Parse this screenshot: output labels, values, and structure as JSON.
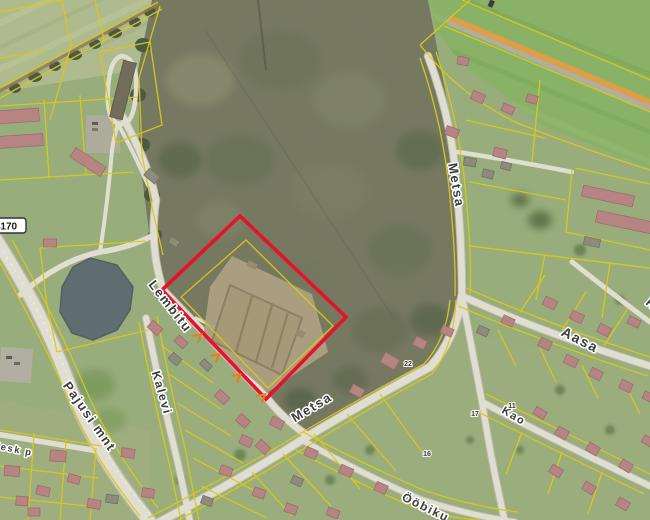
{
  "map": {
    "type": "aerial-cadastral-map",
    "highlight_parcel": {
      "color": "#e8112d",
      "stroke_width": 3.6,
      "points": [
        [
          240,
          216
        ],
        [
          346,
          317
        ],
        [
          266,
          399
        ],
        [
          162,
          290
        ]
      ]
    },
    "street_labels": [
      {
        "id": "lembitu",
        "text": "Lembitu",
        "x": 167,
        "y": 309,
        "rot": 52,
        "size": 13
      },
      {
        "id": "kalevi",
        "text": "Kalevi",
        "x": 158,
        "y": 394,
        "rot": 74,
        "size": 12
      },
      {
        "id": "pajusi-mnt",
        "text": "Pajusi mnt",
        "x": 86,
        "y": 419,
        "rot": 55,
        "size": 13
      },
      {
        "id": "metsa-north",
        "text": "Metsa",
        "x": 452,
        "y": 186,
        "rot": 80,
        "size": 13
      },
      {
        "id": "metsa-central",
        "text": "Metsa",
        "x": 314,
        "y": 411,
        "rot": -31,
        "size": 13
      },
      {
        "id": "aasa",
        "text": "Aasa",
        "x": 578,
        "y": 344,
        "rot": 27,
        "size": 14
      },
      {
        "id": "kao",
        "text": "Kao",
        "x": 512,
        "y": 419,
        "rot": 31,
        "size": 11
      },
      {
        "id": "oobiku",
        "text": "Ööbiku",
        "x": 424,
        "y": 511,
        "rot": 26,
        "size": 12
      },
      {
        "id": "kesk-p",
        "text": "Kesk p",
        "x": 12,
        "y": 452,
        "rot": 11,
        "size": 9.5
      },
      {
        "id": "edge-partial",
        "text": "R",
        "x": 649,
        "y": 307,
        "rot": 40,
        "size": 12
      }
    ],
    "road_number_badge": {
      "text": "4170",
      "x": 2,
      "y": 226
    },
    "house_numbers": [
      {
        "text": "22",
        "x": 408,
        "y": 366
      },
      {
        "text": "17",
        "x": 475,
        "y": 416
      },
      {
        "text": "11",
        "x": 512,
        "y": 408
      },
      {
        "text": "16",
        "x": 427,
        "y": 456
      }
    ],
    "route_markers": {
      "color": "#e0821e",
      "rotation": 52,
      "positions": [
        [
          198,
          337
        ],
        [
          216,
          357
        ],
        [
          237,
          377
        ],
        [
          262,
          397
        ]
      ]
    },
    "houses": [
      [
        18,
        116,
        -4,
        42,
        13,
        "p"
      ],
      [
        20,
        141,
        -4,
        46,
        12,
        "p"
      ],
      [
        88,
        162,
        33,
        36,
        11,
        "p"
      ],
      [
        123,
        90,
        14,
        13,
        58,
        "d"
      ],
      [
        152,
        176,
        40,
        14,
        9,
        "g"
      ],
      [
        174,
        242,
        32,
        10,
        7,
        "g"
      ],
      [
        50,
        243,
        0,
        13,
        8,
        "p"
      ],
      [
        608,
        196,
        12,
        52,
        11,
        "p"
      ],
      [
        624,
        222,
        12,
        56,
        12,
        "p"
      ],
      [
        592,
        242,
        12,
        16,
        8,
        "g"
      ],
      [
        452,
        132,
        20,
        13,
        9,
        "p"
      ],
      [
        500,
        153,
        15,
        13,
        9,
        "p"
      ],
      [
        470,
        162,
        10,
        12,
        8,
        "g"
      ],
      [
        488,
        174,
        15,
        11,
        8,
        "g"
      ],
      [
        506,
        166,
        15,
        10,
        7,
        "g"
      ],
      [
        478,
        97,
        24,
        13,
        9,
        "p"
      ],
      [
        508,
        109,
        24,
        12,
        8,
        "p"
      ],
      [
        532,
        99,
        15,
        11,
        8,
        "p"
      ],
      [
        463,
        61,
        10,
        11,
        8,
        "p"
      ],
      [
        550,
        303,
        26,
        13,
        9,
        "p"
      ],
      [
        577,
        317,
        26,
        13,
        9,
        "p"
      ],
      [
        604,
        330,
        26,
        12,
        9,
        "p"
      ],
      [
        634,
        322,
        26,
        12,
        8,
        "p"
      ],
      [
        545,
        344,
        26,
        12,
        9,
        "p"
      ],
      [
        571,
        361,
        26,
        13,
        9,
        "p"
      ],
      [
        596,
        374,
        26,
        12,
        9,
        "p"
      ],
      [
        626,
        386,
        26,
        12,
        9,
        "p"
      ],
      [
        649,
        397,
        26,
        12,
        8,
        "p"
      ],
      [
        390,
        361,
        30,
        16,
        11,
        "p"
      ],
      [
        357,
        391,
        28,
        13,
        9,
        "p"
      ],
      [
        420,
        343,
        26,
        12,
        9,
        "p"
      ],
      [
        447,
        331,
        24,
        12,
        8,
        "p"
      ],
      [
        483,
        331,
        24,
        11,
        8,
        "g"
      ],
      [
        508,
        321,
        24,
        12,
        8,
        "p"
      ],
      [
        277,
        423,
        26,
        13,
        9,
        "p"
      ],
      [
        246,
        441,
        24,
        12,
        9,
        "p"
      ],
      [
        311,
        453,
        24,
        12,
        9,
        "p"
      ],
      [
        346,
        471,
        24,
        13,
        9,
        "p"
      ],
      [
        381,
        488,
        24,
        12,
        9,
        "p"
      ],
      [
        297,
        481,
        24,
        11,
        8,
        "g"
      ],
      [
        540,
        413,
        31,
        12,
        8,
        "p"
      ],
      [
        562,
        433,
        31,
        12,
        9,
        "p"
      ],
      [
        593,
        449,
        31,
        12,
        9,
        "p"
      ],
      [
        626,
        466,
        31,
        12,
        9,
        "p"
      ],
      [
        556,
        471,
        31,
        12,
        9,
        "p"
      ],
      [
        589,
        488,
        31,
        12,
        9,
        "p"
      ],
      [
        623,
        504,
        31,
        12,
        9,
        "p"
      ],
      [
        648,
        441,
        31,
        11,
        8,
        "p"
      ],
      [
        226,
        471,
        20,
        12,
        9,
        "p"
      ],
      [
        259,
        493,
        20,
        12,
        9,
        "p"
      ],
      [
        291,
        509,
        20,
        12,
        9,
        "p"
      ],
      [
        333,
        513,
        20,
        12,
        8,
        "p"
      ],
      [
        207,
        501,
        20,
        11,
        8,
        "g"
      ],
      [
        155,
        328,
        42,
        13,
        9,
        "p"
      ],
      [
        181,
        342,
        42,
        12,
        8,
        "p"
      ],
      [
        175,
        359,
        42,
        11,
        8,
        "g"
      ],
      [
        206,
        365,
        42,
        11,
        7,
        "g"
      ],
      [
        222,
        397,
        42,
        13,
        9,
        "p"
      ],
      [
        243,
        421,
        42,
        12,
        9,
        "p"
      ],
      [
        263,
        447,
        42,
        13,
        9,
        "p"
      ],
      [
        128,
        453,
        8,
        13,
        9,
        "p"
      ],
      [
        148,
        493,
        8,
        12,
        9,
        "p"
      ],
      [
        112,
        499,
        8,
        12,
        8,
        "g"
      ],
      [
        58,
        456,
        4,
        16,
        11,
        "p"
      ],
      [
        12,
        471,
        4,
        15,
        10,
        "p"
      ],
      [
        43,
        491,
        14,
        13,
        9,
        "p"
      ],
      [
        74,
        479,
        14,
        12,
        8,
        "p"
      ],
      [
        22,
        501,
        4,
        12,
        9,
        "p"
      ],
      [
        34,
        512,
        0,
        12,
        8,
        "p"
      ],
      [
        94,
        504,
        10,
        13,
        9,
        "p"
      ]
    ],
    "colors": {
      "highlight_red": "#e8112d",
      "cadastral_yellow": "#e6d40e",
      "route_orange": "#f0a13c",
      "road_white": "#efece1",
      "main_road_beige": "#e9dfba",
      "pond": "#5c6a71",
      "forest": "#75775f",
      "grass": "#9cb37e",
      "field_top_left": "#b7c293",
      "field_top_right": "#8bb967",
      "roof_pink": "#c08487",
      "label_gray": "#3d3d3d"
    }
  }
}
